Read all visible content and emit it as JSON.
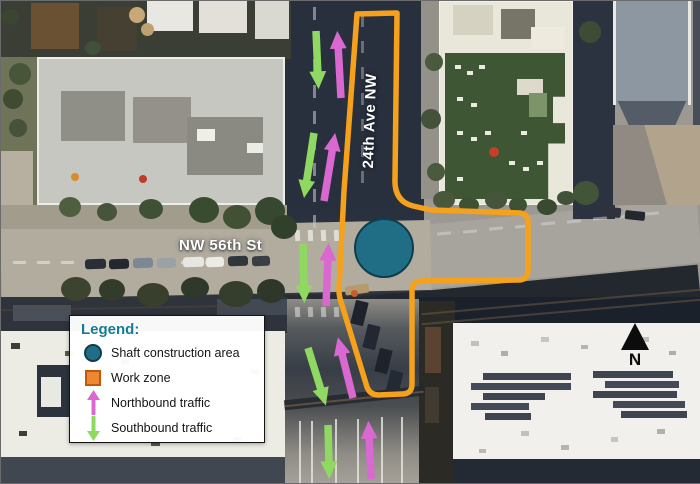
{
  "map": {
    "h_street_label": "NW 56th St",
    "v_street_label": "24th Ave NW"
  },
  "legend": {
    "title": "Legend:",
    "items": [
      {
        "label": "Shaft construction area",
        "symbol": "shaft-circle"
      },
      {
        "label": "Work zone",
        "symbol": "work-zone-square"
      },
      {
        "label": "Northbound traffic",
        "symbol": "northbound-arrow"
      },
      {
        "label": "Southbound traffic",
        "symbol": "southbound-arrow"
      }
    ]
  },
  "compass": {
    "label": "N"
  },
  "colors": {
    "work_zone": "#F5A11C",
    "shaft_circle": "#1F6E86",
    "shaft_circle_border": "#123C4E",
    "northbound": "#D969D0",
    "southbound": "#8FD862",
    "legend_title": "#147C95",
    "legend_square_fill": "#EE8731",
    "legend_square_border": "#C3560B"
  },
  "annotations": {
    "work_zone_path": "M356 13 L396 12 L394 178 Q393 200 412 205 L430 209 L519 212 Q527 213 527 221 L527 269 Q527 279 517 279 L421 280 Q411 280 411 290 L411 383 Q411 393 401 393 L378 394 Q369 394 366 386 L341 304 Q338 296 338 289 L343 190 Z",
    "shaft_area": {
      "cx": 383,
      "cy": 247,
      "r": 29
    },
    "northbound_arrows": [
      [
        340,
        97,
        337,
        43
      ],
      [
        323,
        200,
        332,
        145
      ],
      [
        325,
        305,
        327,
        255
      ],
      [
        352,
        397,
        340,
        349
      ],
      [
        370,
        478,
        368,
        433
      ]
    ],
    "southbound_arrows": [
      [
        315,
        30,
        317,
        75
      ],
      [
        313,
        132,
        305,
        184
      ],
      [
        302,
        243,
        303,
        289
      ],
      [
        307,
        347,
        321,
        392
      ],
      [
        327,
        424,
        328,
        465
      ]
    ]
  }
}
